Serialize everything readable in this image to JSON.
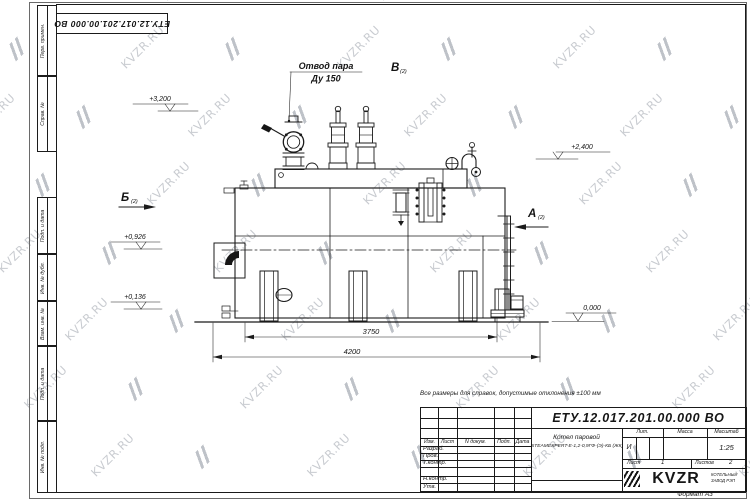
{
  "watermark": {
    "text": "KVZR.RU"
  },
  "margin": {
    "labels": [
      "Перв. примен.",
      "Справ. №",
      "Подп. и дата",
      "Инв. № дубл.",
      "Взам. инв. №",
      "Подп. и дата",
      "Инв. № подл."
    ]
  },
  "corner_stamp": {
    "doc_number": "ЕТУ.12.017.201.00.000  ВО"
  },
  "drawing": {
    "steam_outlet_label": "Отвод пара",
    "steam_outlet_size": "Ду 150",
    "views": {
      "b": "Б",
      "b_ref": "(2)",
      "v": "В",
      "v_ref": "(2)",
      "a": "А",
      "a_ref": "(2)"
    },
    "elevations": {
      "top": "+3,200",
      "right": "+2,400",
      "mid": "+0,926",
      "low": "+0,136",
      "zero": "0,000"
    },
    "dimensions": {
      "inner": "3750",
      "overall": "4200"
    }
  },
  "note": "Все размеры для справок, допустимые отклонения  ±100 мм",
  "title_block": {
    "doc_number": "ЕТУ.12.017.201.00.000  ВО",
    "header": [
      "Изм.",
      "Лист",
      "N докум.",
      "Подп.",
      "Дата"
    ],
    "rows": [
      "Разраб.",
      "Пров.",
      "Т.контр.",
      "Н.контр.",
      "Утв."
    ],
    "product_name": "Котел паровой",
    "product_model": "STEAMEXPERT-Е-1,2-0,9ГФ-(Э)-КБ (ЖК)",
    "lit_label": "Лит.",
    "lit_value": "И",
    "mass_label": "Масса",
    "scale_label": "Масштаб",
    "scale_value": "1:25",
    "sheet_label": "Лист",
    "sheet_value": "1",
    "sheets_label": "Листов",
    "sheets_value": "2",
    "logo_text": "KVZR",
    "logo_caption1": "КОТЕЛЬНЫЙ",
    "logo_caption2": "ЗАВОД РЭП",
    "format": "Формат А3"
  }
}
